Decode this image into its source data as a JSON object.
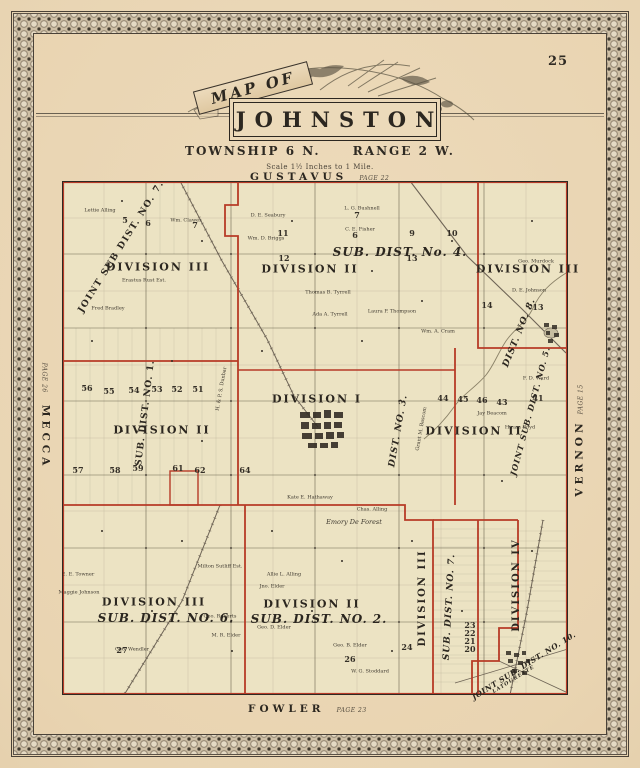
{
  "page_number": "25",
  "title": {
    "kicker": "MAP OF",
    "name": "JOHNSTON",
    "township": "TOWNSHIP 6 N.",
    "range": "RANGE 2 W.",
    "scale": "Scale 1½ Inches to 1 Mile."
  },
  "edges": {
    "north": {
      "name": "GUSTAVUS",
      "page": "PAGE 22"
    },
    "south": {
      "name": "FOWLER",
      "page": "PAGE 23"
    },
    "west": {
      "name": "MECCA",
      "page": "PAGE 26"
    },
    "east": {
      "name": "VERNON",
      "page": "PAGE 15"
    }
  },
  "colors": {
    "paper": "#e9d6b6",
    "map_bg": "#ece3c3",
    "boundary_red": "#b73b27",
    "ink": "#2f2a23"
  },
  "districts": [
    {
      "text": "JOINT SUB DIST. NO. 7.",
      "x": 60,
      "y": 66,
      "rot": -58,
      "size": 9,
      "sp": 1.5
    },
    {
      "text": "DIVISION III",
      "x": 96,
      "y": 86,
      "size": 11,
      "sp": 2
    },
    {
      "text": "DIVISION II",
      "x": 248,
      "y": 88,
      "size": 11,
      "sp": 2
    },
    {
      "text": "SUB. DIST. No. 4.",
      "x": 338,
      "y": 71,
      "size": 12,
      "italic": true,
      "sp": 1
    },
    {
      "text": "DIVISION III",
      "x": 466,
      "y": 88,
      "size": 11,
      "sp": 2
    },
    {
      "text": "SUB. DIST. NO. 1.",
      "x": 84,
      "y": 232,
      "rot": -83,
      "size": 9,
      "sp": 1
    },
    {
      "text": "DIVISION II",
      "x": 100,
      "y": 249,
      "size": 11,
      "sp": 2
    },
    {
      "text": "DIVISION I",
      "x": 255,
      "y": 218,
      "size": 11,
      "sp": 2
    },
    {
      "text": "DIST. NO. 3.",
      "x": 337,
      "y": 250,
      "rot": -80,
      "size": 9,
      "italic": true,
      "sp": 1
    },
    {
      "text": "DIVISION II",
      "x": 412,
      "y": 250,
      "size": 11,
      "sp": 2
    },
    {
      "text": "DIST. NO. 8.",
      "x": 458,
      "y": 152,
      "rot": -68,
      "size": 9,
      "italic": true,
      "sp": 1
    },
    {
      "text": "JOINT SUB. DIST. NO. 5.",
      "x": 468,
      "y": 230,
      "rot": -75,
      "size": 8,
      "italic": true,
      "sp": 1
    },
    {
      "text": "DIVISION III",
      "x": 92,
      "y": 421,
      "size": 11,
      "sp": 2
    },
    {
      "text": "SUB. DIST. NO. 6.",
      "x": 104,
      "y": 437,
      "size": 12,
      "italic": true,
      "sp": 1
    },
    {
      "text": "DIVISION II",
      "x": 250,
      "y": 423,
      "size": 11,
      "sp": 2
    },
    {
      "text": "SUB. DIST. NO. 2.",
      "x": 257,
      "y": 438,
      "size": 12,
      "italic": true,
      "sp": 1
    },
    {
      "text": "DIVISION III",
      "x": 361,
      "y": 417,
      "rot": -90,
      "size": 10,
      "sp": 2
    },
    {
      "text": "SUB. DIST. NO. 7.",
      "x": 388,
      "y": 426,
      "rot": -87,
      "size": 9,
      "italic": true,
      "sp": 1
    },
    {
      "text": "DIVISION IV",
      "x": 455,
      "y": 404,
      "rot": -90,
      "size": 10,
      "sp": 2
    },
    {
      "text": "JOINT SUB. DIST. NO. 10.",
      "x": 462,
      "y": 485,
      "rot": -32,
      "size": 7.5,
      "italic": true,
      "sp": 0.5
    },
    {
      "text": "LATOURETTE",
      "x": 452,
      "y": 499,
      "rot": -32,
      "size": 5,
      "italic": true,
      "sp": 1
    }
  ],
  "owners": [
    {
      "text": "Lettie Alling",
      "x": 38,
      "y": 30
    },
    {
      "text": "Wm. Clawes",
      "x": 124,
      "y": 40
    },
    {
      "text": "D. E. Seabury",
      "x": 206,
      "y": 35
    },
    {
      "text": "Wm. D. Briggs",
      "x": 204,
      "y": 58
    },
    {
      "text": "L. G. Bushnell",
      "x": 300,
      "y": 28
    },
    {
      "text": "C. E. Fisher",
      "x": 298,
      "y": 49
    },
    {
      "text": "Erastus Rust Est.",
      "x": 82,
      "y": 100
    },
    {
      "text": "Thomas B. Tyrrell",
      "x": 266,
      "y": 112
    },
    {
      "text": "Ada A. Tyrrell",
      "x": 268,
      "y": 134
    },
    {
      "text": "Laura P. Thompson",
      "x": 330,
      "y": 131
    },
    {
      "text": "Wm. A. Cram",
      "x": 376,
      "y": 151
    },
    {
      "text": "Geo. Murdock",
      "x": 474,
      "y": 81
    },
    {
      "text": "D. E. Johnson",
      "x": 467,
      "y": 110
    },
    {
      "text": "F. D. Ward",
      "x": 474,
      "y": 198
    },
    {
      "text": "Jay Beacom",
      "x": 430,
      "y": 233
    },
    {
      "text": "Hiram Boyd",
      "x": 458,
      "y": 247
    },
    {
      "text": "H. & P. S. Dunbar",
      "x": 160,
      "y": 208,
      "rot": -80
    },
    {
      "text": "Grant M. Bascom",
      "x": 360,
      "y": 248,
      "rot": -80
    },
    {
      "text": "Milton Sutliff Est.",
      "x": 158,
      "y": 386
    },
    {
      "text": "E. E. Towner",
      "x": 16,
      "y": 394
    },
    {
      "text": "Maggie Johnson",
      "x": 17,
      "y": 412
    },
    {
      "text": "Geo. Wendler",
      "x": 70,
      "y": 469
    },
    {
      "text": "M. R. Elder",
      "x": 164,
      "y": 455
    },
    {
      "text": "Geo. Roberts",
      "x": 158,
      "y": 436
    },
    {
      "text": "Allie L. Alling",
      "x": 222,
      "y": 394
    },
    {
      "text": "Jno. Elder",
      "x": 210,
      "y": 406
    },
    {
      "text": "Geo. D. Elder",
      "x": 212,
      "y": 447
    },
    {
      "text": "Emory De Forest",
      "x": 292,
      "y": 341,
      "size": 6.5,
      "italic": true
    },
    {
      "text": "Kate E. Hathaway",
      "x": 248,
      "y": 317
    },
    {
      "text": "Chas. Alling",
      "x": 310,
      "y": 329
    },
    {
      "text": "Geo. B. Elder",
      "x": 288,
      "y": 465
    },
    {
      "text": "W. G. Stoddard",
      "x": 308,
      "y": 491
    },
    {
      "text": "Fred Bradley",
      "x": 46,
      "y": 128
    }
  ],
  "lots": [
    {
      "n": "5",
      "x": 63,
      "y": 39
    },
    {
      "n": "6",
      "x": 86,
      "y": 42
    },
    {
      "n": "7",
      "x": 133,
      "y": 44
    },
    {
      "n": "7",
      "x": 295,
      "y": 34
    },
    {
      "n": "6",
      "x": 293,
      "y": 54
    },
    {
      "n": "9",
      "x": 350,
      "y": 52
    },
    {
      "n": "10",
      "x": 390,
      "y": 52
    },
    {
      "n": "11",
      "x": 221,
      "y": 52
    },
    {
      "n": "12",
      "x": 222,
      "y": 77
    },
    {
      "n": "13",
      "x": 350,
      "y": 77
    },
    {
      "n": "14",
      "x": 425,
      "y": 124
    },
    {
      "n": "13",
      "x": 476,
      "y": 126
    },
    {
      "n": "56",
      "x": 25,
      "y": 207
    },
    {
      "n": "55",
      "x": 47,
      "y": 210
    },
    {
      "n": "54",
      "x": 72,
      "y": 209
    },
    {
      "n": "53",
      "x": 95,
      "y": 208
    },
    {
      "n": "52",
      "x": 115,
      "y": 208
    },
    {
      "n": "51",
      "x": 136,
      "y": 208
    },
    {
      "n": "57",
      "x": 16,
      "y": 289
    },
    {
      "n": "58",
      "x": 53,
      "y": 289
    },
    {
      "n": "59",
      "x": 76,
      "y": 287
    },
    {
      "n": "61",
      "x": 116,
      "y": 287
    },
    {
      "n": "62",
      "x": 138,
      "y": 289
    },
    {
      "n": "64",
      "x": 183,
      "y": 289
    },
    {
      "n": "44",
      "x": 381,
      "y": 217
    },
    {
      "n": "45",
      "x": 401,
      "y": 218
    },
    {
      "n": "46",
      "x": 420,
      "y": 219
    },
    {
      "n": "43",
      "x": 440,
      "y": 221
    },
    {
      "n": "41",
      "x": 476,
      "y": 217
    },
    {
      "n": "27",
      "x": 60,
      "y": 469
    },
    {
      "n": "26",
      "x": 288,
      "y": 478
    },
    {
      "n": "24",
      "x": 345,
      "y": 466
    },
    {
      "n": "23",
      "x": 408,
      "y": 444
    },
    {
      "n": "22",
      "x": 408,
      "y": 452
    },
    {
      "n": "21",
      "x": 408,
      "y": 460
    },
    {
      "n": "20",
      "x": 408,
      "y": 468
    }
  ]
}
